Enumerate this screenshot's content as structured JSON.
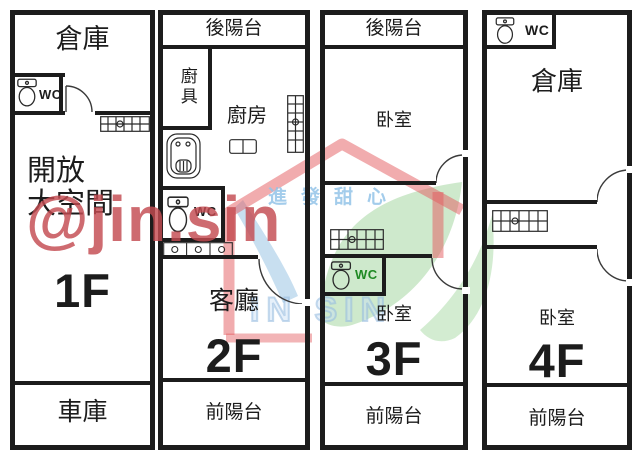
{
  "page": {
    "background": "#ffffff",
    "line_color": "#1c1c1c"
  },
  "units": [
    {
      "name": "floor-1",
      "labels": {
        "storage": "倉庫",
        "wc": "WC",
        "open_space": "開放\n大空間",
        "floor": "1F",
        "garage": "車庫"
      }
    },
    {
      "name": "floor-2",
      "labels": {
        "back_balcony": "後陽台",
        "kitchen_cabinet": "廚具",
        "kitchen": "廚房",
        "wc": "WC",
        "living_room": "客廳",
        "floor": "2F",
        "front_balcony": "前陽台"
      }
    },
    {
      "name": "floor-3",
      "labels": {
        "back_balcony": "後陽台",
        "bedroom_back": "卧室",
        "wc": "WC",
        "bedroom_front": "卧室",
        "floor": "3F",
        "front_balcony": "前陽台"
      }
    },
    {
      "name": "floor-4",
      "labels": {
        "wc": "WC",
        "storage": "倉庫",
        "bedroom": "卧室",
        "floor": "4F",
        "front_balcony": "前陽台"
      }
    }
  ],
  "watermarks": {
    "handle": "@jin.sin",
    "handle_color": "#c34a50",
    "brand_text": "進發甜心",
    "brand_text_color": "#93c4e8",
    "brand_caps": "IN SIN",
    "brand_caps_color": "#a9cde9",
    "logo_roof_color": "#e45a5e",
    "logo_leaf_color": "#9ed49a",
    "logo_swoosh_color": "#86b7dd",
    "wc_green_color": "#1f8a24"
  }
}
